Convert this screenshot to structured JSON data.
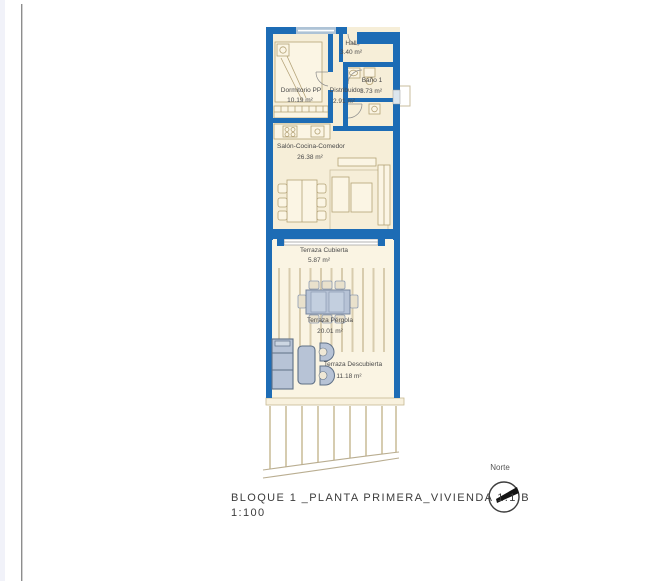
{
  "plan": {
    "rooms": [
      {
        "id": "dormitorio",
        "name": "Dormitorio PP",
        "area": "10.19 m²"
      },
      {
        "id": "hall",
        "name": "Hall",
        "area": "3.40 m²"
      },
      {
        "id": "distribuidor",
        "name": "Distribuidor",
        "area": "2.91 m²"
      },
      {
        "id": "bano",
        "name": "Baño 1",
        "area": "3.73 m²"
      },
      {
        "id": "salon",
        "name": "Salón-Cocina-Comedor",
        "area": "26.38 m²"
      },
      {
        "id": "terraza-cubierta",
        "name": "Terraza Cubierta",
        "area": "5.87 m²"
      },
      {
        "id": "terraza-pergola",
        "name": "Terraza Pérgola",
        "area": "20.01 m²"
      },
      {
        "id": "terraza-descubierta",
        "name": "Terraza Descubierta",
        "area": "11.18 m²"
      }
    ],
    "colors": {
      "wall_blue": "#1d6cb5",
      "floor_cream": "#f6eed8",
      "terrace_cream": "#faf4e3",
      "outdoor_furniture": "#b7c3d6",
      "pergola_stripe": "#d8ccae",
      "label_text": "#4a4a4a"
    }
  },
  "footer": {
    "title": "BLOQUE 1 _PLANTA PRIMERA_VIVIENDA 1.1.B",
    "scale": "1:100"
  },
  "compass": {
    "label": "Norte"
  }
}
